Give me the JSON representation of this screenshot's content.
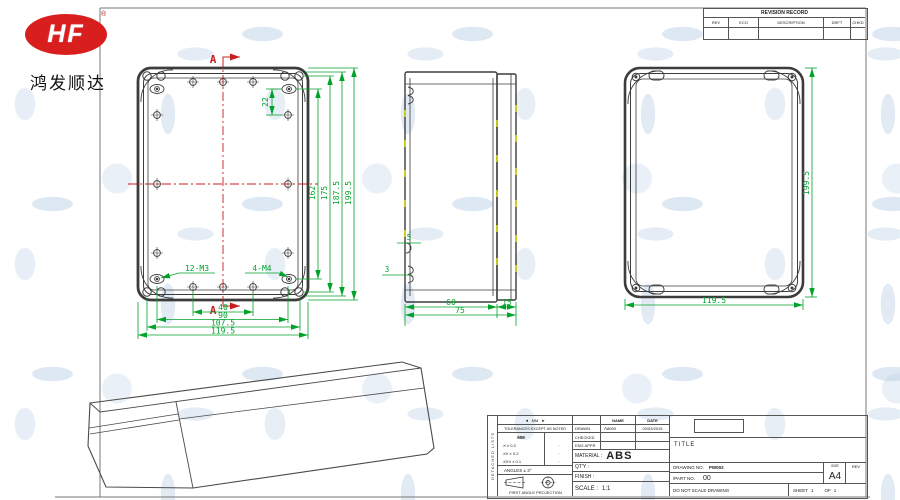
{
  "logo": {
    "text": "HF",
    "reg": "®",
    "subtitle": "鸿发顺达"
  },
  "icons": {
    "arrow_left": "◄",
    "arrow_right": "►"
  },
  "colors": {
    "logo_red": "#d91e1e",
    "dim_green": "#00a32a",
    "centerline_red": "#c81d1d",
    "line_gray": "#3c3c3c",
    "tick_yellow": "#d4d400",
    "watermark_blue": "#dbe7f3"
  },
  "revision_table": {
    "title": "REVISION RECORD",
    "headers": [
      "REV",
      "ECO",
      "DESCRIPTION",
      "DRFT",
      "CHKD"
    ]
  },
  "front_view": {
    "section_label_top": "A",
    "section_label_bottom": "A",
    "dim_pitch": "22",
    "dims_vertical": [
      "162",
      "175",
      "187.5",
      "199.5"
    ],
    "dims_horizontal": [
      "40",
      "90",
      "107.5",
      "119.5"
    ],
    "hole_label_m3": "12-M3",
    "hole_label_m4": "4-M4"
  },
  "side_view": {
    "dim_rib": "5",
    "dim_wall": "3",
    "dim_depth_body": "60",
    "dim_depth_lid": "15",
    "dim_depth_total": "75"
  },
  "back_view": {
    "dim_height": "199.5",
    "dim_width": "119.5"
  },
  "title_block": {
    "side_note": "DETACHED LISTS",
    "units_note": "MM",
    "tolerance_note": "TOLERANCES EXCEPT AS NOTED",
    "tol_header": "MM",
    "tol_rows": [
      ".X ± 0.3",
      ".XX ± 0.2",
      ".XXX ± 0.1"
    ],
    "tol_dot": "·",
    "angles_note": "ANGLES ± 3°",
    "projection_note": "FIRST ANGLE PROJECTION",
    "name_header": "NAME",
    "date_header": "DATE",
    "drawn_label": "DRAWN",
    "drawn_name": "Aaron",
    "drawn_date": "02/03/2015",
    "checked_label": "CHECKED",
    "eng_appr_label": "ENG APPR",
    "material_label": "MATERIAL :",
    "material_value": "ABS",
    "qty_label": "QT'Y :",
    "finish_label": "FINISH :",
    "scale_label": "SCALE :",
    "scale_value": "1:1",
    "title_label": "TITLE",
    "drawing_no_label": "DRAWING NO.",
    "drawing_no_value": "PW002",
    "part_no_label": "/PART NO.",
    "part_no_value": "00",
    "size_label": "SIZE",
    "size_value": "A4",
    "rev_label": "REV",
    "do_not_scale": "DO NOT SCALE DRAWING",
    "sheet_label": "SHEET",
    "sheet_number": "1",
    "of_label": "OF",
    "of_number": "1"
  }
}
